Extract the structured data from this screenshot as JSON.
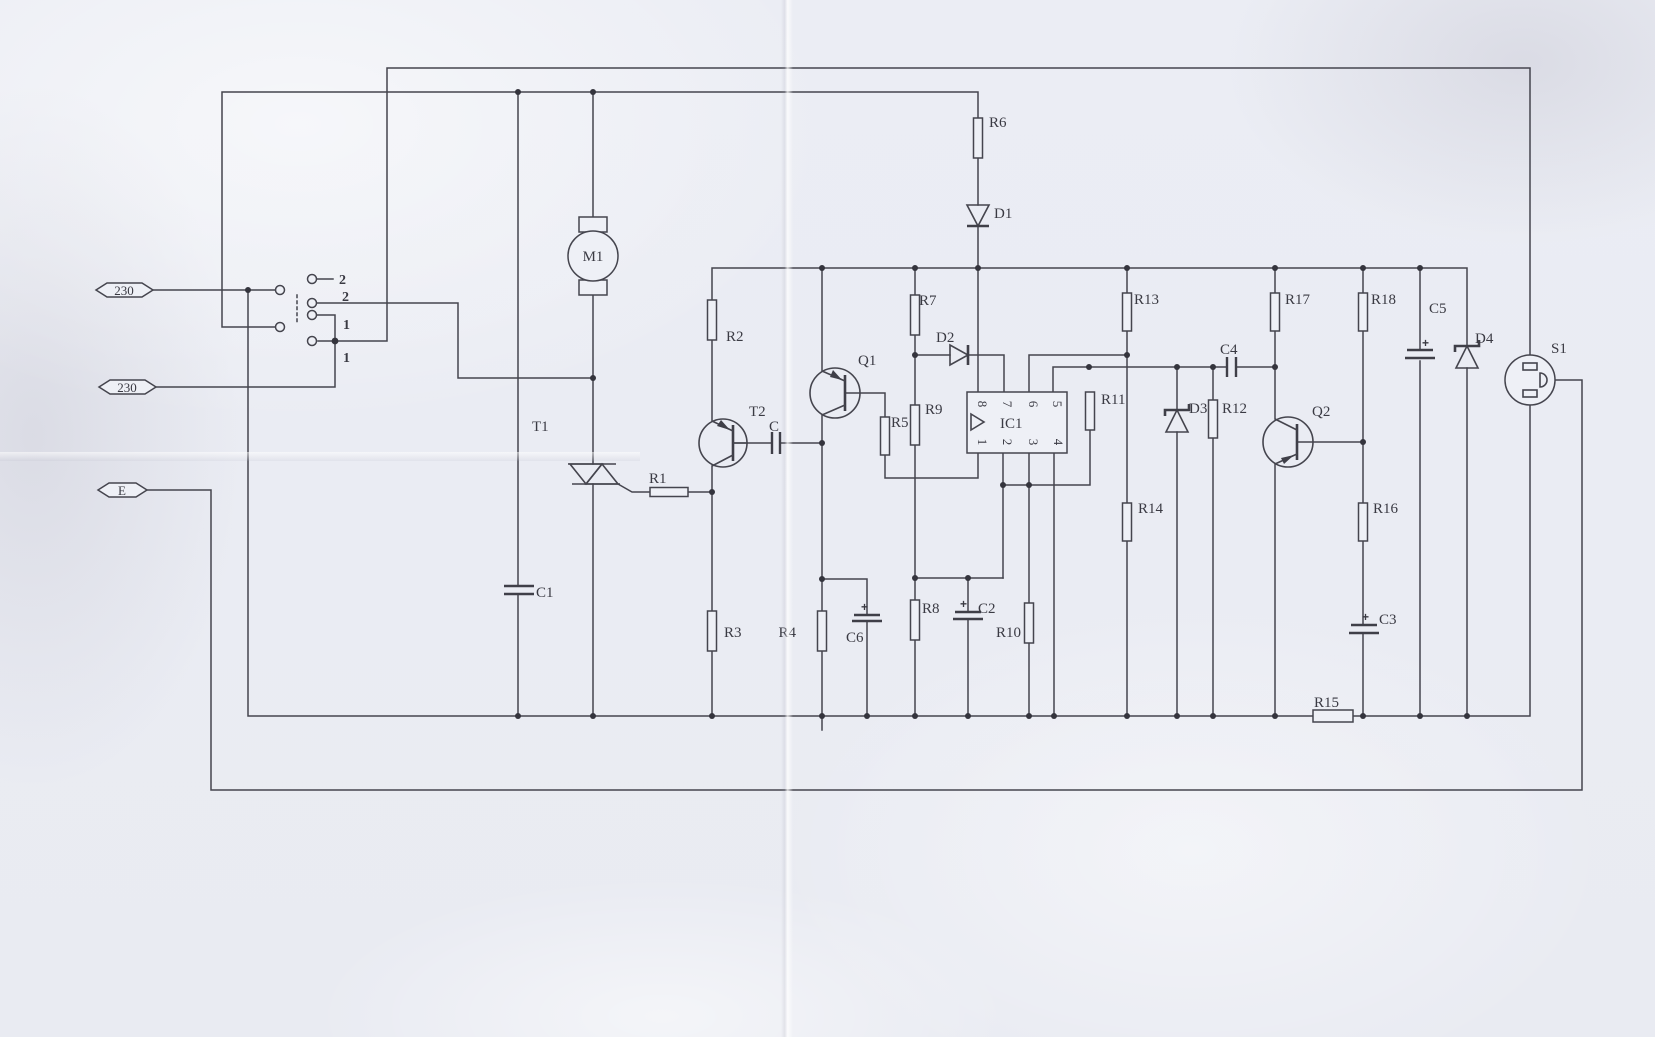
{
  "terminals": {
    "live": "230",
    "neutral": "230",
    "earth": "E"
  },
  "switch": {
    "labels": [
      "2",
      "2",
      "1",
      "1"
    ]
  },
  "components": {
    "M1": "M1",
    "T1": "T1",
    "T2": "T2",
    "Q1": "Q1",
    "Q2": "Q2",
    "S1": "S1",
    "IC1": "IC1",
    "C": "C",
    "C1": "C1",
    "C2": "C2",
    "C3": "C3",
    "C4": "C4",
    "C5": "C5",
    "C6": "C6",
    "D1": "D1",
    "D2": "D2",
    "D3": "D3",
    "D4": "D4",
    "R1": "R1",
    "R2": "R2",
    "R3": "R3",
    "R4": "R4",
    "R5": "R5",
    "R6": "R6",
    "R7": "R7",
    "R8": "R8",
    "R9": "R9",
    "R10": "R10",
    "R11": "R11",
    "R12": "R12",
    "R13": "R13",
    "R14": "R14",
    "R15": "R15",
    "R16": "R16",
    "R17": "R17",
    "R18": "R18"
  },
  "ic1": {
    "pins_top": [
      "8",
      "7",
      "6",
      "5"
    ],
    "pins_bottom": [
      "1",
      "2",
      "3",
      "4"
    ]
  },
  "marks": {
    "plus": "+"
  }
}
